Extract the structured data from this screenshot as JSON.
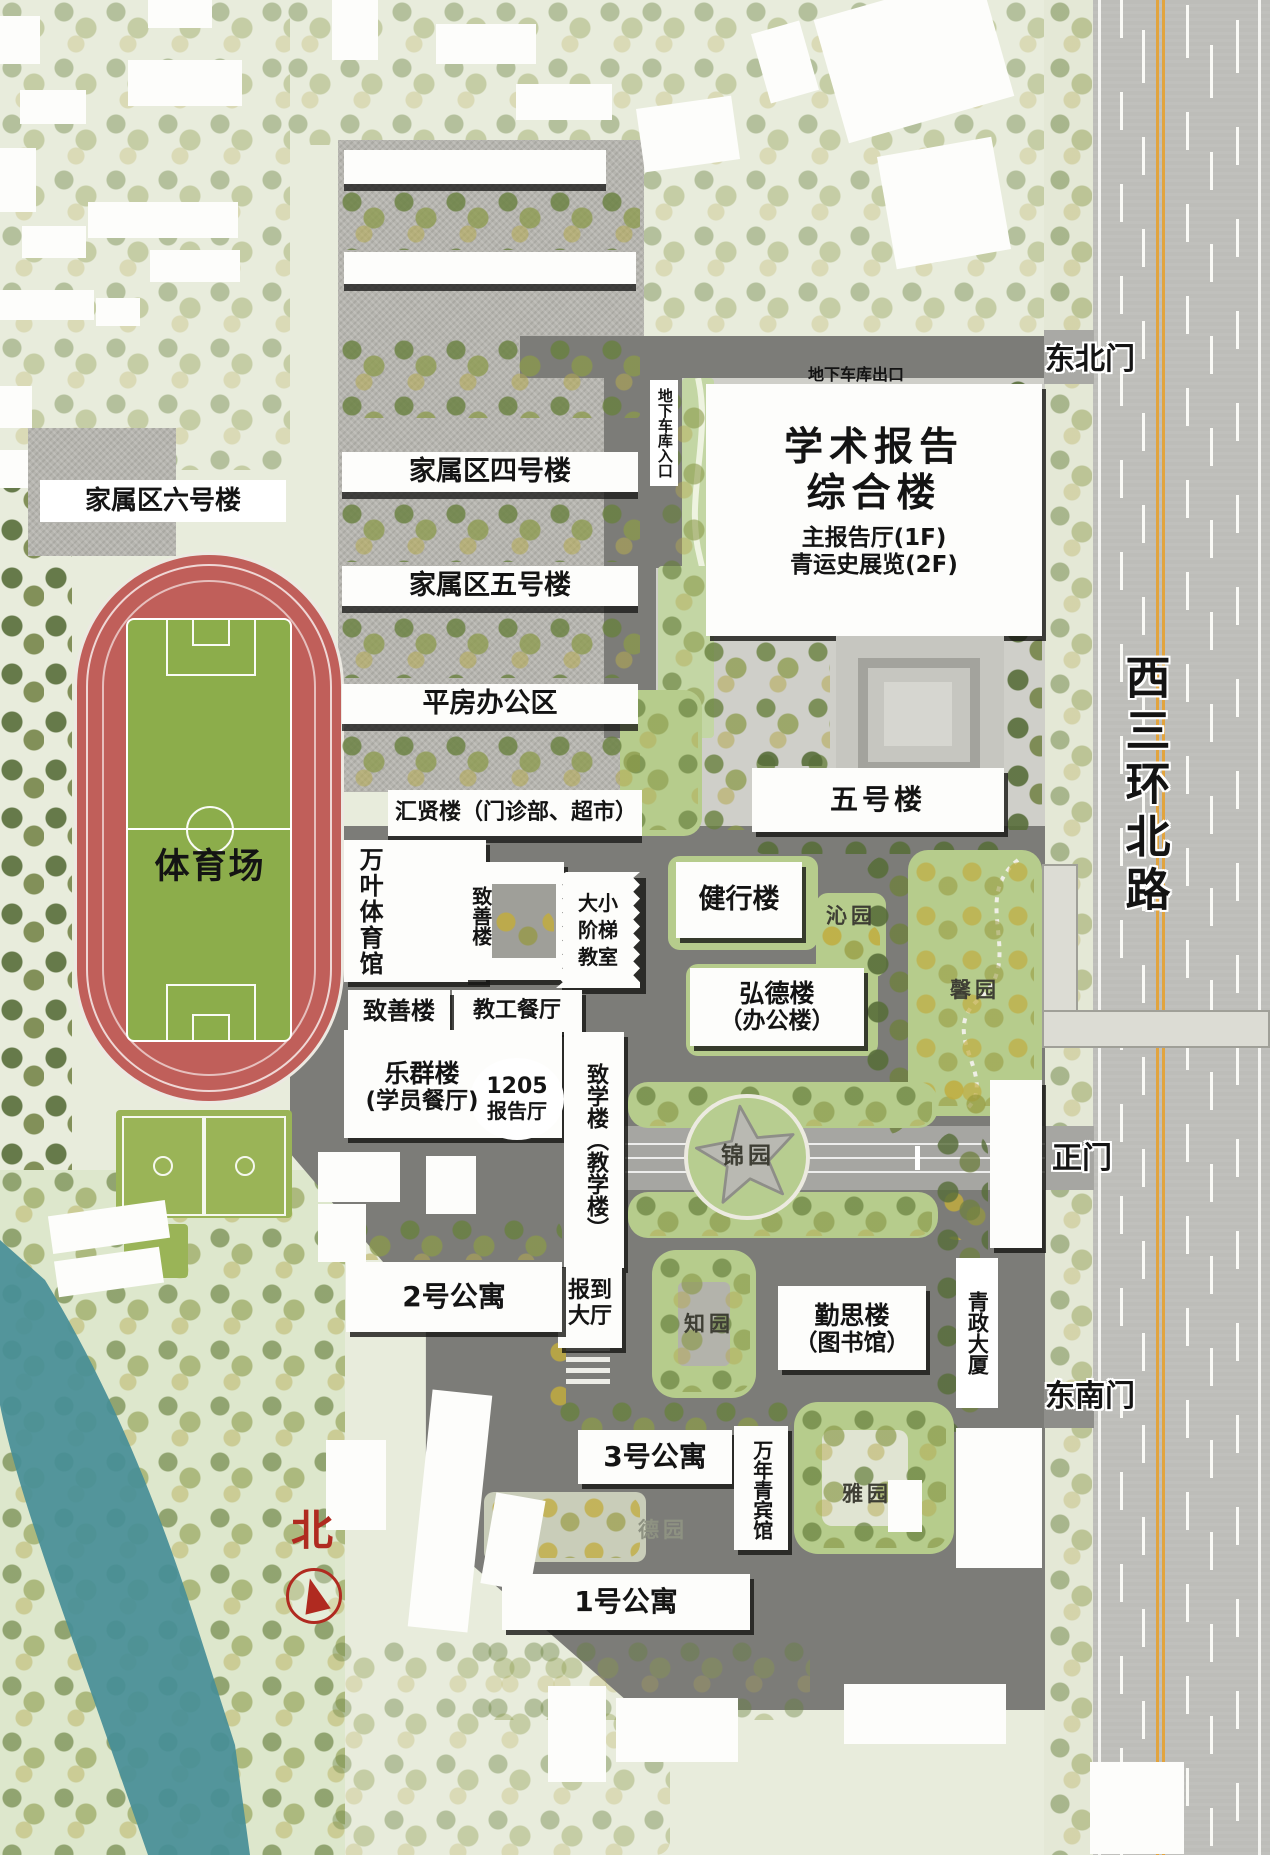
{
  "colors": {
    "bg": "#e8ecdc",
    "road": "#7c7c78",
    "lawn": "#b6cc8c",
    "track": "#c05f5a",
    "field": "#8cad4b",
    "water": "#468e97",
    "lane_orange": "#e2a43e",
    "north_red": "#b02a20"
  },
  "labels": {
    "family6": "家属区六号楼",
    "family4": "家属区四号楼",
    "family5": "家属区五号楼",
    "pingfang": "平房办公区",
    "huixian": "汇贤楼（门诊部、超市）",
    "wanye": "万叶体育馆",
    "zhishan_v": "致善楼",
    "ladder_rooms": "大小阶梯教室",
    "jiaogong": "教工餐厅",
    "zhishan_h": "致善楼",
    "lequn_1": "乐群楼",
    "lequn_2": "(学员餐厅)",
    "hall1205_1": "1205",
    "hall1205_2": "报告厅",
    "zhixue": "致学楼（教学楼）",
    "wuhao": "五号楼",
    "jianxing": "健行楼",
    "qinyuan": "沁园",
    "hongde_1": "弘德楼",
    "hongde_2": "（办公楼）",
    "xinyuan": "馨园",
    "jinyuan": "锦园",
    "apt2": "2号公寓",
    "baodao": "报到大厅",
    "zhiyuan": "知园",
    "qinsi_1": "勤思楼",
    "qinsi_2": "（图书馆）",
    "qingzheng": "青政大厦",
    "apt3": "3号公寓",
    "wannianqing": "万年青宾馆",
    "yayuan": "雅园",
    "deyuan": "德园",
    "apt1": "1号公寓",
    "stadium": "体育场",
    "gate_ne": "东北门",
    "gate_main": "正门",
    "gate_se": "东南门",
    "road_name": "西三环北路",
    "garage_exit": "地下车库出口",
    "garage_entry": "地下车库入口",
    "academic_1": "学术报告",
    "academic_2": "综合楼",
    "academic_3": "主报告厅(1F)",
    "academic_4": "青运史展览(2F)",
    "north": "北"
  }
}
